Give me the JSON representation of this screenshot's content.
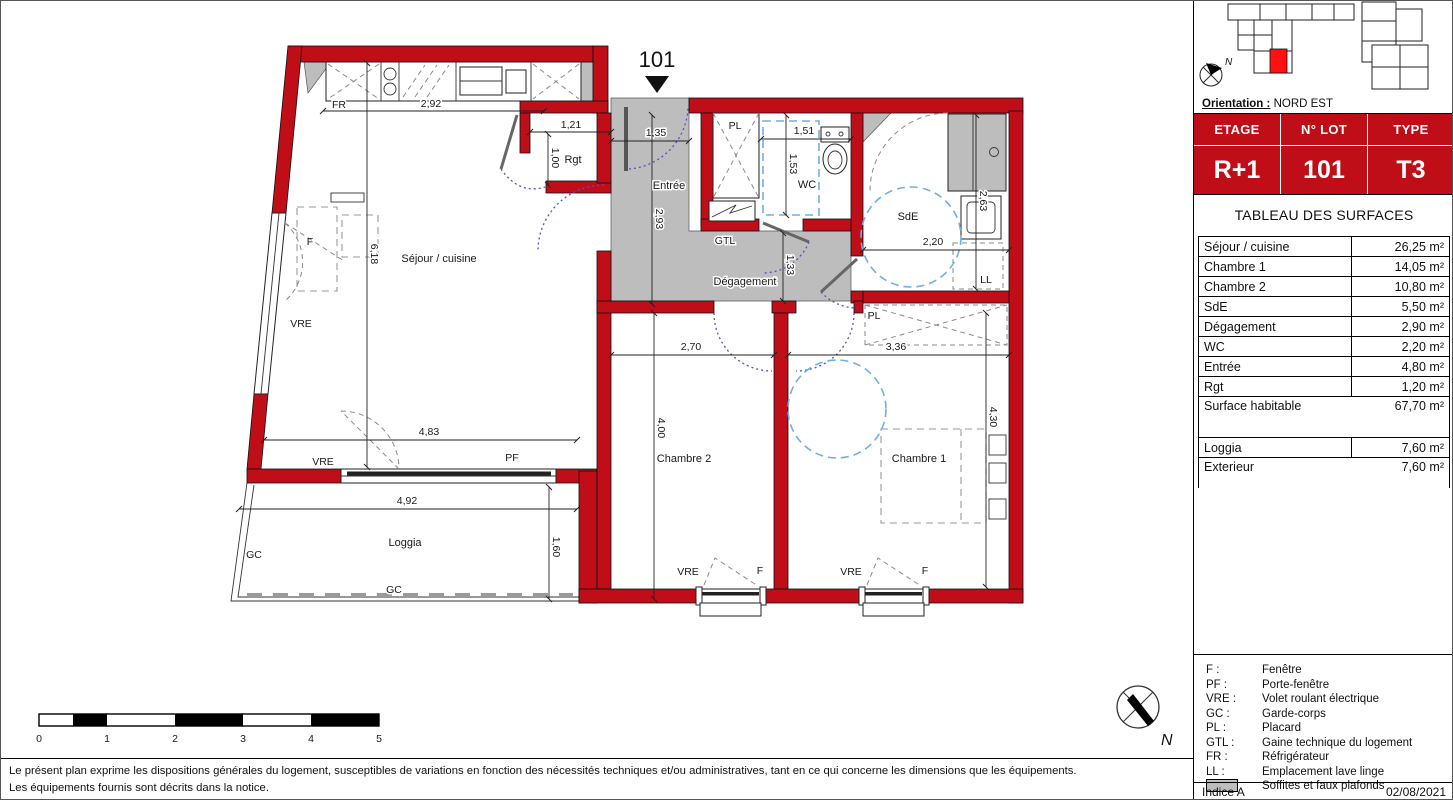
{
  "plan": {
    "unit_marker": "101",
    "rooms": {
      "sejour": "Séjour / cuisine",
      "rgt": "Rgt",
      "entree": "Entrée",
      "wc": "WC",
      "sde": "SdE",
      "degagement": "Dégagement",
      "gtl": "GTL",
      "chambre2": "Chambre 2",
      "chambre1": "Chambre 1",
      "loggia": "Loggia",
      "ll": "LL"
    },
    "dims": {
      "kitchen_w": "2,92",
      "rgt_w": "1,21",
      "rgt_h": "1,00",
      "entree_w": "1,35",
      "entree_h": "2,93",
      "wc_w": "1,51",
      "wc_h": "1,53",
      "sde_w": "2,20",
      "sde_h": "2,63",
      "degagement_h": "1,33",
      "ch2_w": "2,70",
      "ch1_w": "3,36",
      "ch2_h": "4,00",
      "ch1_h": "4,30",
      "sejour_h": "6,18",
      "sejour_w": "4,83",
      "loggia_w": "4,92",
      "loggia_h": "1,60"
    },
    "tags": {
      "f": "F",
      "pf": "PF",
      "vre": "VRE",
      "gc": "GC",
      "pl": "PL",
      "fr": "FR",
      "ll": "LL",
      "gtl": "GTL"
    },
    "north_label": "N"
  },
  "scale_bar": {
    "ticks": [
      "0",
      "1",
      "2",
      "3",
      "4",
      "5"
    ]
  },
  "panel": {
    "orientation_label": "Orientation :",
    "orientation_value": "NORD EST",
    "lot_table": {
      "col1_header": "ETAGE",
      "col2_header": "N° LOT",
      "col3_header": "TYPE",
      "col1_value": "R+1",
      "col2_value": "101",
      "col3_value": "T3"
    },
    "surfaces_title": "TABLEAU DES SURFACES",
    "surfaces": [
      {
        "label": "Séjour / cuisine",
        "value": "26,25 m²"
      },
      {
        "label": "Chambre 1",
        "value": "14,05 m²"
      },
      {
        "label": "Chambre 2",
        "value": "10,80 m²"
      },
      {
        "label": "SdE",
        "value": "5,50 m²"
      },
      {
        "label": "Dégagement",
        "value": "2,90 m²"
      },
      {
        "label": "WC",
        "value": "2,20 m²"
      },
      {
        "label": "Entrée",
        "value": "4,80 m²"
      },
      {
        "label": "Rgt",
        "value": "1,20 m²"
      }
    ],
    "total": {
      "label": "Surface habitable",
      "value": "67,70 m²"
    },
    "annex": [
      {
        "label": "Loggia",
        "value": "7,60 m²"
      },
      {
        "label": "Exterieur",
        "value": "7,60 m²"
      }
    ],
    "legend": [
      {
        "abbr": "F :",
        "label": "Fenêtre"
      },
      {
        "abbr": "PF :",
        "label": "Porte-fenêtre"
      },
      {
        "abbr": "VRE :",
        "label": "Volet roulant électrique"
      },
      {
        "abbr": "GC :",
        "label": "Garde-corps"
      },
      {
        "abbr": "PL :",
        "label": "Placard"
      },
      {
        "abbr": "GTL :",
        "label": "Gaine technique du logement"
      },
      {
        "abbr": "FR :",
        "label": "Réfrigérateur"
      },
      {
        "abbr": "LL :",
        "label": "Emplacement lave linge"
      },
      {
        "abbr": "",
        "label": "Soffites et faux plafonds"
      }
    ],
    "indice": "Indice A",
    "date": "02/08/2021"
  },
  "footer": {
    "line1": "Le présent plan exprime les dispositions générales du logement, susceptibles de variations en fonction des nécessités techniques et/ou administratives, tant en ce qui concerne les dimensions que les équipements.",
    "line2": "Les équipements fournis sont décrits dans la notice."
  },
  "colors": {
    "wall_red": "#C00E19",
    "soffit_gray": "#BDBDBD",
    "circle_blue": "#6FAFE8",
    "door_violet": "#5353C0"
  }
}
